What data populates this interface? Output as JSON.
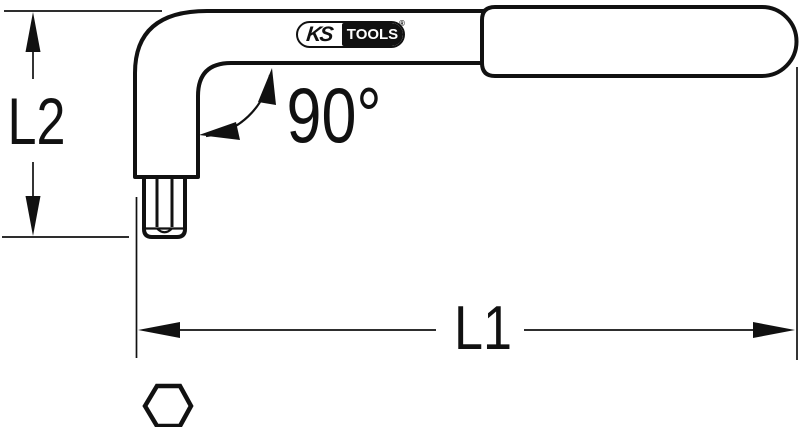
{
  "logo": {
    "ks": "KS",
    "tools": "TOOLS",
    "registered": "®"
  },
  "dimensions": {
    "l2": {
      "label": "L2"
    },
    "l1": {
      "label": "L1"
    },
    "angle": {
      "label": "90°"
    }
  },
  "icons": {
    "hex_cross_section": "hexagon-outline-icon"
  },
  "colors": {
    "line": "#111111",
    "background": "#ffffff",
    "logo_block": "#111111",
    "logo_text": "#ffffff"
  }
}
